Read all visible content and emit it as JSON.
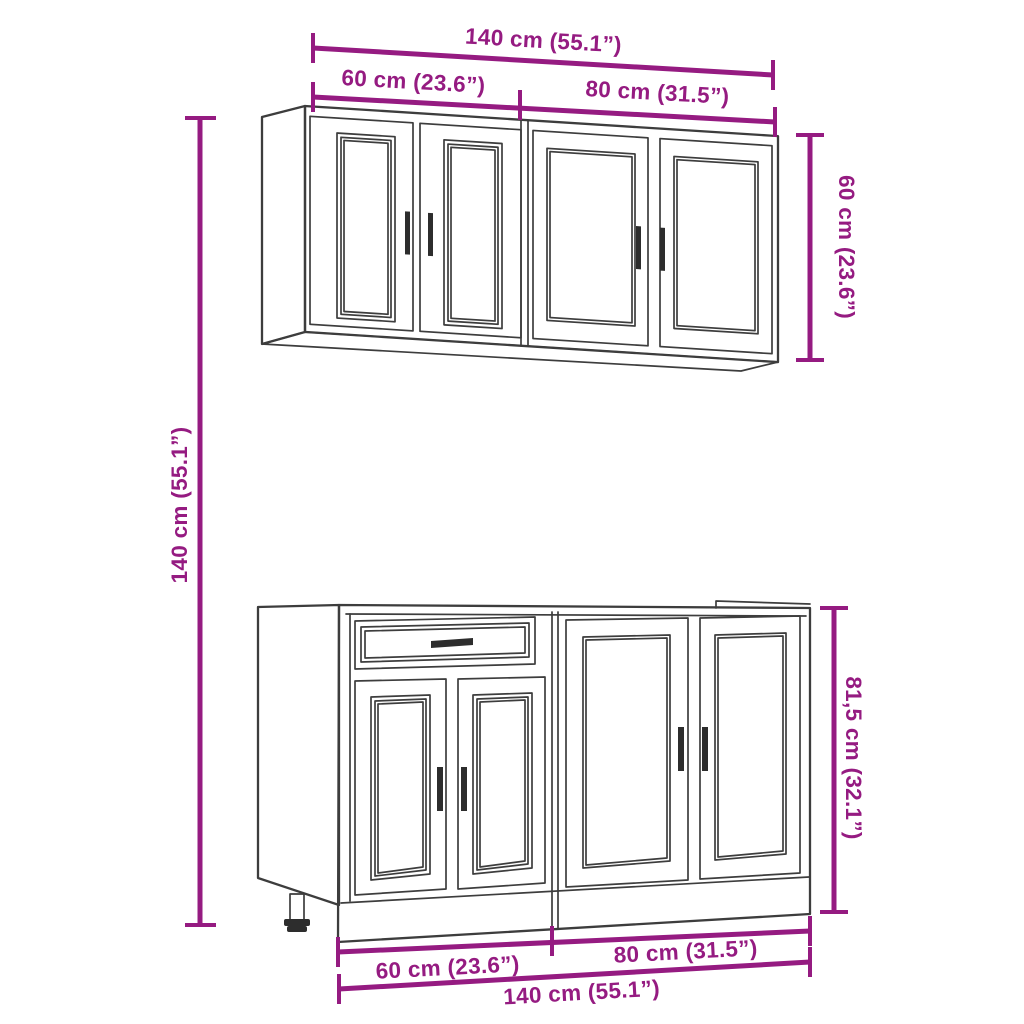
{
  "diagram": {
    "colors": {
      "dimension_accent": "#951b81",
      "line_art": "#3d3d3d",
      "background": "#ffffff"
    },
    "dimensions": {
      "top_total": "140 cm (55.1”)",
      "top_left_segment": "60 cm (23.6”)",
      "top_right_segment": "80 cm (31.5”)",
      "upper_cabinet_height": "60 cm (23.6”)",
      "total_height": "140 cm (55.1”)",
      "base_cabinet_height": "81,5 cm (32.1”)",
      "bottom_left_segment": "60 cm (23.6”)",
      "bottom_right_segment": "80 cm (31.5”)",
      "bottom_total": "140 cm (55.1”)"
    }
  }
}
